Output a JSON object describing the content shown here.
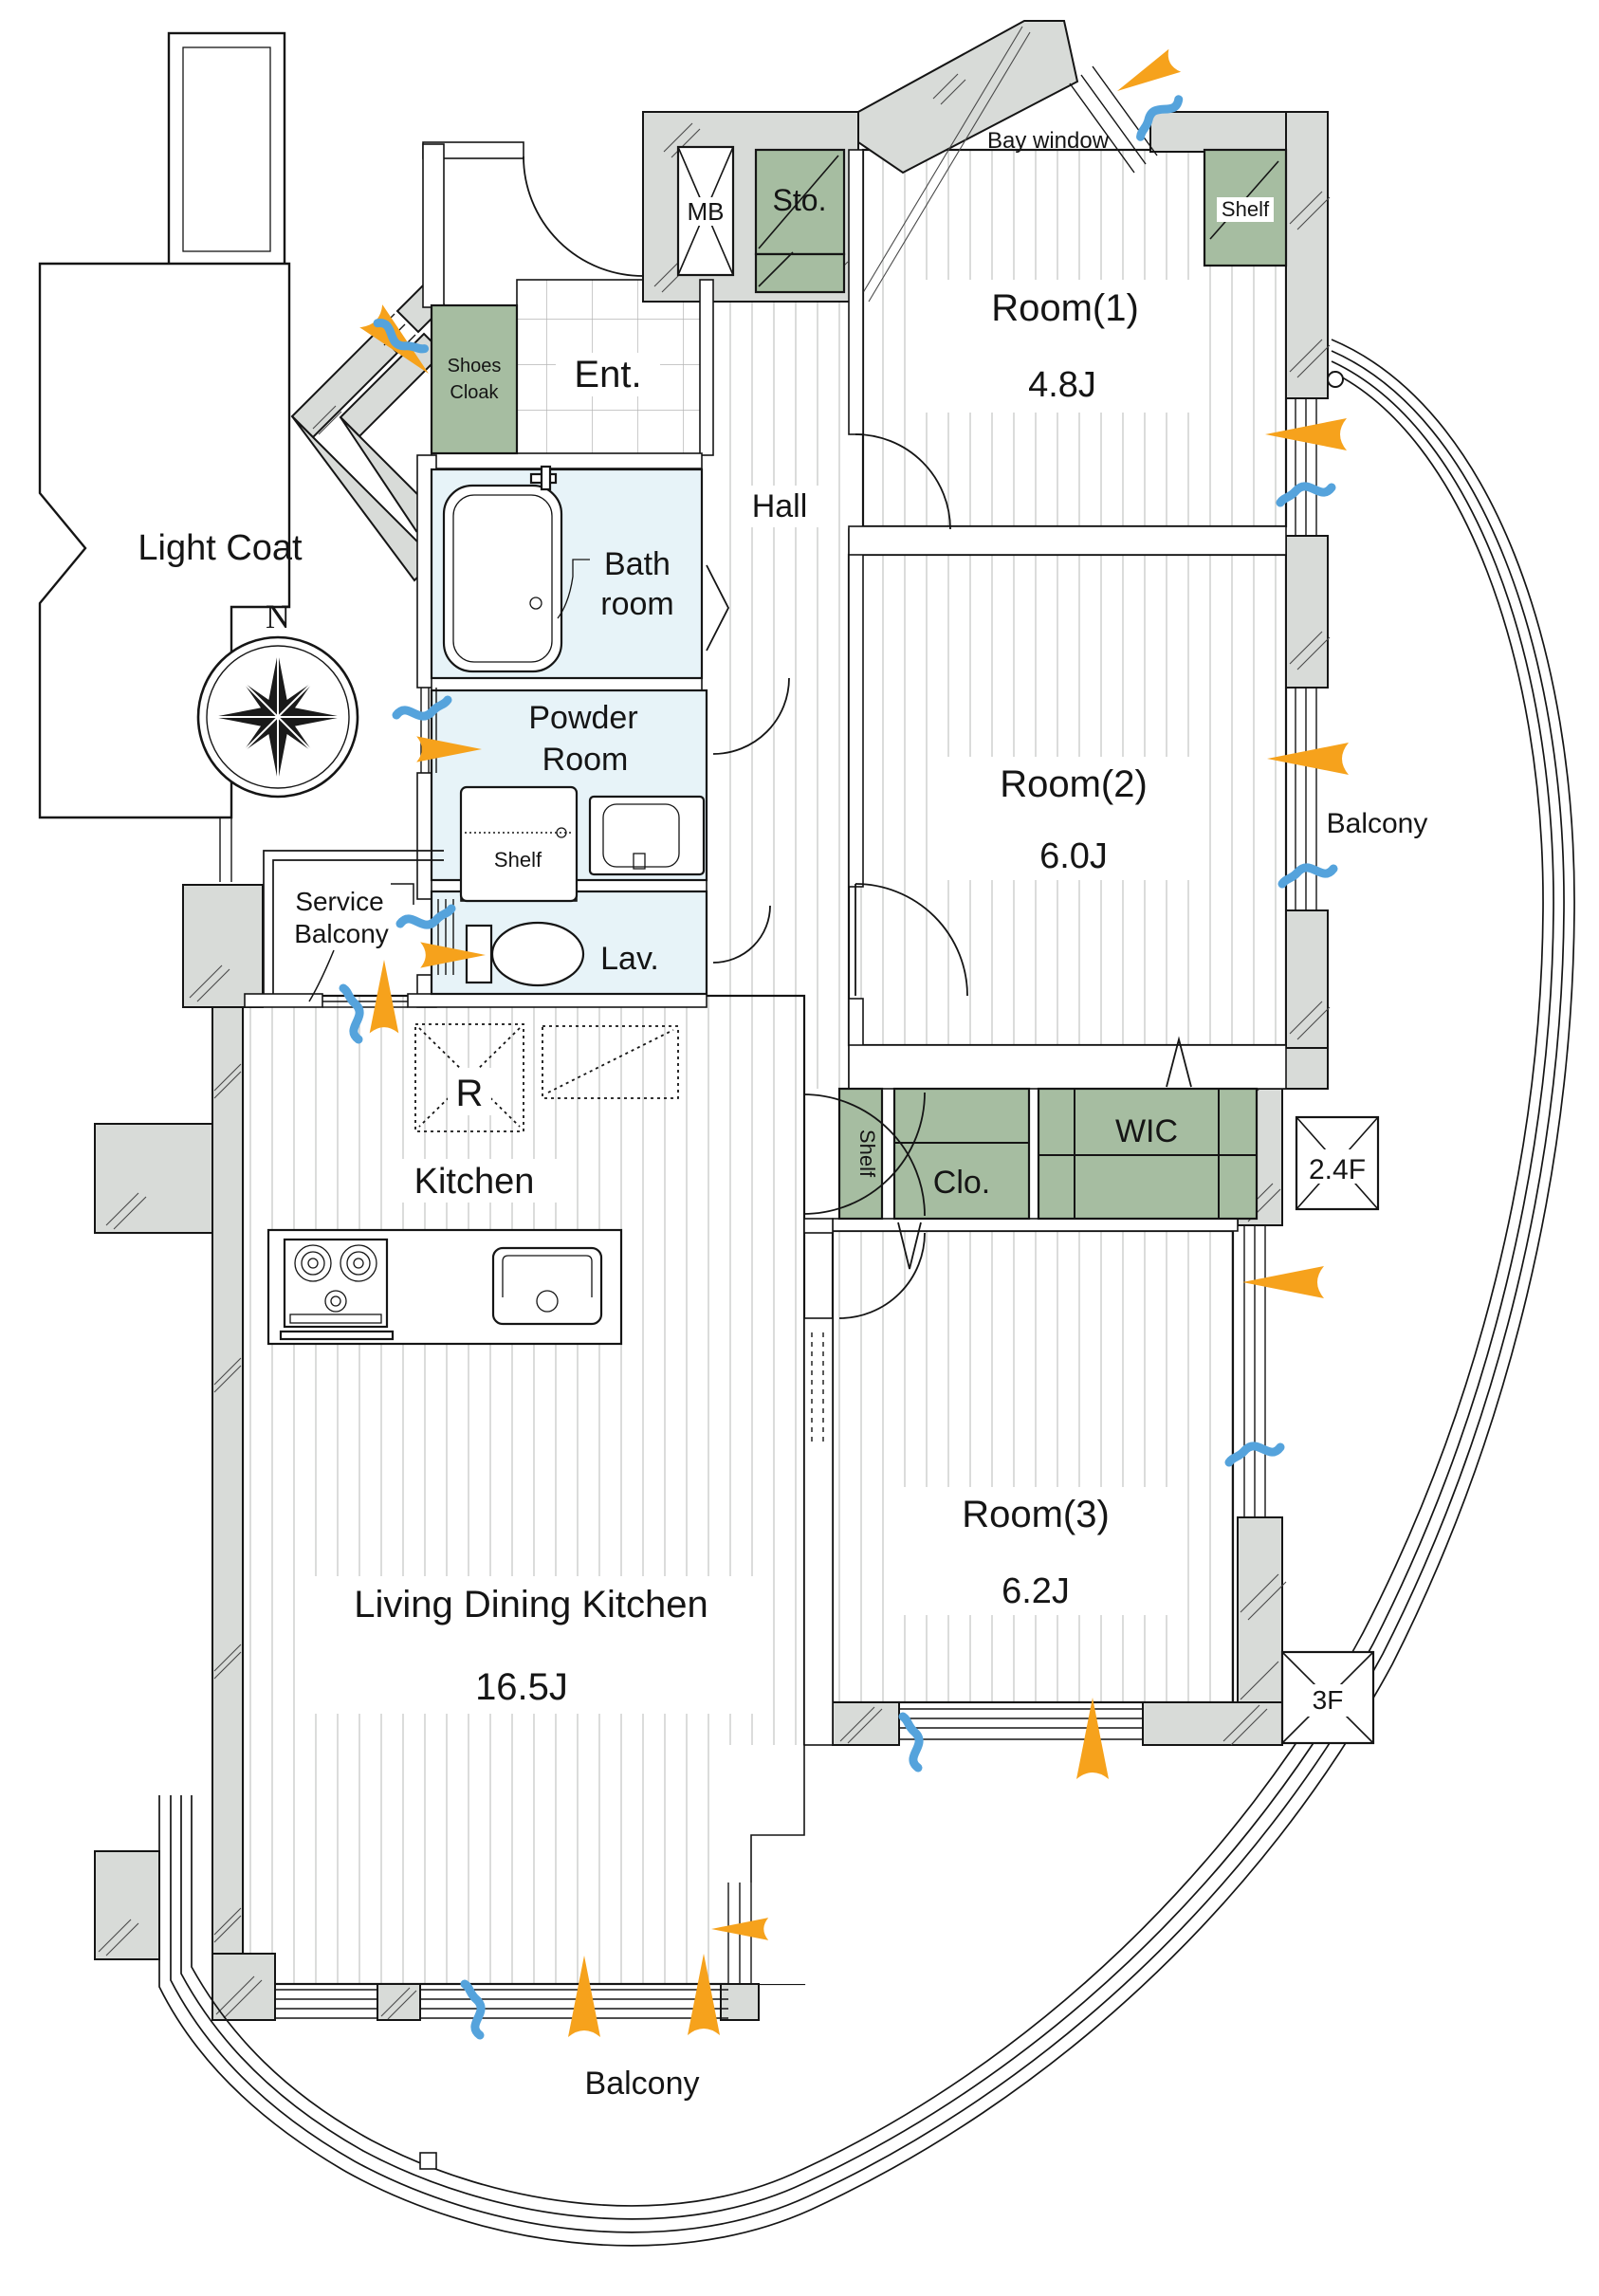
{
  "plan": {
    "compass": "N",
    "light_court": "Light Coat",
    "bay_window": "Bay window",
    "meter_box": "MB",
    "storage": "Sto.",
    "shelf_room1": "Shelf",
    "shelf_powder": "Shelf",
    "shelf_hall": "Shelf",
    "room1_name": "Room(1)",
    "room1_size": "4.8J",
    "room2_name": "Room(2)",
    "room2_size": "6.0J",
    "room3_name": "Room(3)",
    "room3_size": "6.2J",
    "ldk_name": "Living Dining Kitchen",
    "ldk_size": "16.5J",
    "kitchen": "Kitchen",
    "refrigerator": "R",
    "hall": "Hall",
    "entrance": "Ent.",
    "shoes_cloak_line1": "Shoes",
    "shoes_cloak_line2": "Cloak",
    "bath_line1": "Bath",
    "bath_line2": "room",
    "powder_line1": "Powder",
    "powder_line2": "Room",
    "service_line1": "Service",
    "service_line2": "Balcony",
    "lavatory": "Lav.",
    "wic": "WIC",
    "closet": "Clo.",
    "balcony_right": "Balcony",
    "balcony_bottom": "Balcony",
    "floor_24": "2.4F",
    "floor_3": "3F"
  },
  "colors": {
    "wall_gray": "#d8dbd8",
    "storage_green": "#a6bda1",
    "wet_blue": "#e7f3f8",
    "sun_orange": "#F6A21C",
    "wind_blue": "#55A3DC",
    "floor_stripe": "#c3c6c3",
    "line": "#111111"
  },
  "icons": {
    "compass": "compass-rose-icon",
    "sunlight": "sunlight-arrow-icon",
    "airflow": "airflow-swoosh-icon"
  }
}
